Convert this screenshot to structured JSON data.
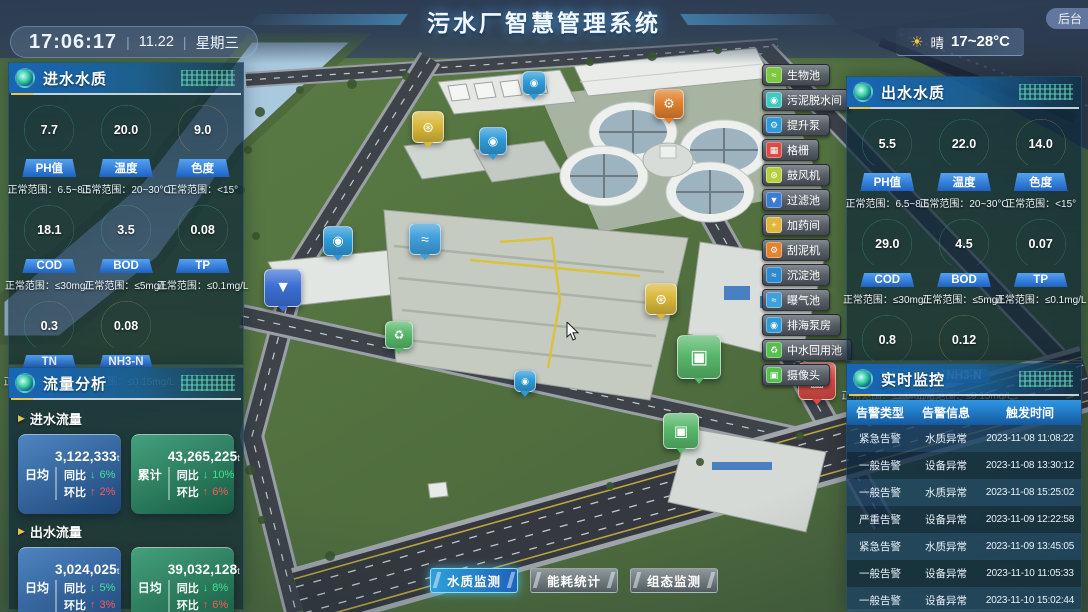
{
  "header": {
    "title": "污水厂智慧管理系统",
    "time": "17:06:17",
    "sep": "|",
    "date": "11.22",
    "weekday": "星期三",
    "sun_icon": "☀",
    "weather_condition": "晴",
    "weather_temp": "17~28°C",
    "backend_button": "后台"
  },
  "panels": {
    "inlet_quality": {
      "title": "进水水质",
      "gauges": [
        {
          "id": "ph",
          "value": "7.7",
          "label": "PH值",
          "range": "正常范围：6.5~8.5",
          "color": "#35dfa0",
          "percent": 72
        },
        {
          "id": "temperature",
          "value": "20.0",
          "label": "温度",
          "range": "正常范围：20~30°C",
          "color": "#35dfa0",
          "percent": 68
        },
        {
          "id": "chroma",
          "value": "9.0",
          "label": "色度",
          "range": "正常范围：<15°",
          "color": "#e8bb4e",
          "percent": 70
        },
        {
          "id": "cod",
          "value": "18.1",
          "label": "COD",
          "range": "正常范围：≤30mg/L",
          "color": "#35dfa0",
          "percent": 60
        },
        {
          "id": "bod",
          "value": "3.5",
          "label": "BOD",
          "range": "正常范围：≤5mg/L",
          "color": "#35dfa0",
          "percent": 62
        },
        {
          "id": "tp",
          "value": "0.08",
          "label": "TP",
          "range": "正常范围：≤0.1mg/L",
          "color": "#35dfa0",
          "percent": 70
        },
        {
          "id": "tn",
          "value": "0.3",
          "label": "TN",
          "range": "正常范围：≤1.0mg/L",
          "color": "#35dfa0",
          "percent": 45
        },
        {
          "id": "nh3n",
          "value": "0.08",
          "label": "NH3-N",
          "range": "正常范围：≤0.15mg/L",
          "color": "#e8bb4e",
          "percent": 55
        }
      ]
    },
    "flow_analysis": {
      "title": "流量分析",
      "caret": "▶",
      "groups": [
        {
          "label": "进水流量",
          "cards": [
            {
              "tag": "日均",
              "value": "3,122,333",
              "unit": "t",
              "style": "blue",
              "yoy_label": "同比",
              "yoy_arrow": "↓",
              "yoy_value": "6%",
              "mom_label": "环比",
              "mom_arrow": "↑",
              "mom_value": "2%"
            },
            {
              "tag": "累计",
              "value": "43,265,225",
              "unit": "t",
              "style": "green",
              "yoy_label": "同比",
              "yoy_arrow": "↓",
              "yoy_value": "10%",
              "mom_label": "环比",
              "mom_arrow": "↑",
              "mom_value": "6%"
            }
          ]
        },
        {
          "label": "出水流量",
          "cards": [
            {
              "tag": "日均",
              "value": "3,024,025",
              "unit": "t",
              "style": "blue",
              "yoy_label": "同比",
              "yoy_arrow": "↓",
              "yoy_value": "5%",
              "mom_label": "环比",
              "mom_arrow": "↑",
              "mom_value": "3%"
            },
            {
              "tag": "日均",
              "value": "39,032,128",
              "unit": "t",
              "style": "green",
              "yoy_label": "同比",
              "yoy_arrow": "↓",
              "yoy_value": "8%",
              "mom_label": "环比",
              "mom_arrow": "↑",
              "mom_value": "6%"
            }
          ]
        }
      ]
    },
    "outlet_quality": {
      "title": "出水水质",
      "gauges": [
        {
          "id": "ph",
          "value": "5.5",
          "label": "PH值",
          "range": "正常范围：6.5~8.5",
          "color": "#35dfa0",
          "percent": 70
        },
        {
          "id": "temperature",
          "value": "22.0",
          "label": "温度",
          "range": "正常范围：20~30°C",
          "color": "#35dfa0",
          "percent": 72
        },
        {
          "id": "chroma",
          "value": "14.0",
          "label": "色度",
          "range": "正常范围：<15°",
          "color": "#e8bb4e",
          "percent": 88
        },
        {
          "id": "cod",
          "value": "29.0",
          "label": "COD",
          "range": "正常范围：≤30mg/L",
          "color": "#35dfa0",
          "percent": 85
        },
        {
          "id": "bod",
          "value": "4.5",
          "label": "BOD",
          "range": "正常范围：≤5mg/L",
          "color": "#35dfa0",
          "percent": 80
        },
        {
          "id": "tp",
          "value": "0.07",
          "label": "TP",
          "range": "正常范围：≤0.1mg/L",
          "color": "#35dfa0",
          "percent": 60
        },
        {
          "id": "tn",
          "value": "0.8",
          "label": "TN",
          "range": "正常范围：≤1.0mg/L",
          "color": "#35dfa0",
          "percent": 68
        },
        {
          "id": "nh3n",
          "value": "0.12",
          "label": "NH3-N",
          "range": "正常范围：≤0.15mg/L",
          "color": "#e8bb4e",
          "percent": 72
        }
      ]
    },
    "monitoring": {
      "title": "实时监控",
      "columns": [
        "告警类型",
        "告警信息",
        "触发时间"
      ],
      "rows": [
        [
          "紧急告警",
          "水质异常",
          "2023-11-08 11:08:22"
        ],
        [
          "一般告警",
          "设备异常",
          "2023-11-08 13:30:12"
        ],
        [
          "一般告警",
          "水质异常",
          "2023-11-08 15:25:02"
        ],
        [
          "严重告警",
          "设备异常",
          "2023-11-09 12:22:58"
        ],
        [
          "紧急告警",
          "水质异常",
          "2023-11-09 13:45:05"
        ],
        [
          "一般告警",
          "设备异常",
          "2023-11-10 11:05:33"
        ],
        [
          "一般告警",
          "设备异常",
          "2023-11-10 15:02:44"
        ]
      ]
    }
  },
  "map_legend": [
    {
      "id": "bio-pool",
      "label": "生物池",
      "color": "#7cc93e",
      "glyph": "≈"
    },
    {
      "id": "sludge-dewatering",
      "label": "污泥脱水间",
      "color": "#3fc9c0",
      "glyph": "◉"
    },
    {
      "id": "lift-pump",
      "label": "提升泵",
      "color": "#2e9ad8",
      "glyph": "⚙"
    },
    {
      "id": "grille",
      "label": "格栅",
      "color": "#d84c45",
      "glyph": "▦"
    },
    {
      "id": "blower",
      "label": "鼓风机",
      "color": "#b7cf3c",
      "glyph": "⊛"
    },
    {
      "id": "filter-pool",
      "label": "过滤池",
      "color": "#3b7bd4",
      "glyph": "▼"
    },
    {
      "id": "dosing-room",
      "label": "加药间",
      "color": "#e0b63c",
      "glyph": "+"
    },
    {
      "id": "mud-scraper",
      "label": "刮泥机",
      "color": "#e0842e",
      "glyph": "⚙"
    },
    {
      "id": "sedimentation-pool",
      "label": "沉淀池",
      "color": "#2e8ad0",
      "glyph": "≈"
    },
    {
      "id": "aeration-pool",
      "label": "曝气池",
      "color": "#3fa0dc",
      "glyph": "≈"
    },
    {
      "id": "sea-pump-house",
      "label": "排海泵房",
      "color": "#2e9ad8",
      "glyph": "◉"
    },
    {
      "id": "water-reuse-pool",
      "label": "中水回用池",
      "color": "#56c04e",
      "glyph": "♻"
    },
    {
      "id": "camera",
      "label": "摄像头",
      "color": "#56c04e",
      "glyph": "▣"
    }
  ],
  "map_markers": [
    {
      "name": "blower-marker",
      "glyph": "⊛",
      "x": 427,
      "y": 126,
      "size": 30,
      "color": "#d9b83b"
    },
    {
      "name": "pump-marker",
      "glyph": "◉",
      "x": 533,
      "y": 82,
      "size": 22,
      "color": "#2e9ad8"
    },
    {
      "name": "lift-pump-marker",
      "glyph": "◉",
      "x": 492,
      "y": 140,
      "size": 26,
      "color": "#2e9ad8"
    },
    {
      "name": "mud-scraper-marker",
      "glyph": "⚙",
      "x": 668,
      "y": 103,
      "size": 28,
      "color": "#e0802e"
    },
    {
      "name": "aeration-pool-marker",
      "glyph": "≈",
      "x": 424,
      "y": 238,
      "size": 30,
      "color": "#3fa0dc"
    },
    {
      "name": "pump-marker",
      "glyph": "◉",
      "x": 337,
      "y": 240,
      "size": 28,
      "color": "#2e9ad8"
    },
    {
      "name": "filter-pool-marker",
      "glyph": "▼",
      "x": 282,
      "y": 287,
      "size": 36,
      "color": "#3b6fd4"
    },
    {
      "name": "water-reuse-marker",
      "glyph": "♻",
      "x": 398,
      "y": 334,
      "size": 26,
      "color": "#57b86a"
    },
    {
      "name": "blower-marker",
      "glyph": "⊛",
      "x": 660,
      "y": 298,
      "size": 30,
      "color": "#d9b83b"
    },
    {
      "name": "camera-marker",
      "glyph": "▣",
      "x": 698,
      "y": 356,
      "size": 42,
      "color": "#57b86a"
    },
    {
      "name": "grille-marker",
      "glyph": "▦",
      "x": 816,
      "y": 380,
      "size": 36,
      "color": "#d84c45"
    },
    {
      "name": "camera-marker",
      "glyph": "▣",
      "x": 680,
      "y": 430,
      "size": 34,
      "color": "#57b86a"
    },
    {
      "name": "pump-marker",
      "glyph": "◉",
      "x": 524,
      "y": 380,
      "size": 20,
      "color": "#2e9ad8"
    }
  ],
  "bottom_tabs": [
    {
      "id": "water-quality-monitor",
      "label": "水质监测",
      "active": true
    },
    {
      "id": "energy-stats",
      "label": "能耗统计",
      "active": false
    },
    {
      "id": "scada-monitor",
      "label": "组态监测",
      "active": false
    }
  ]
}
